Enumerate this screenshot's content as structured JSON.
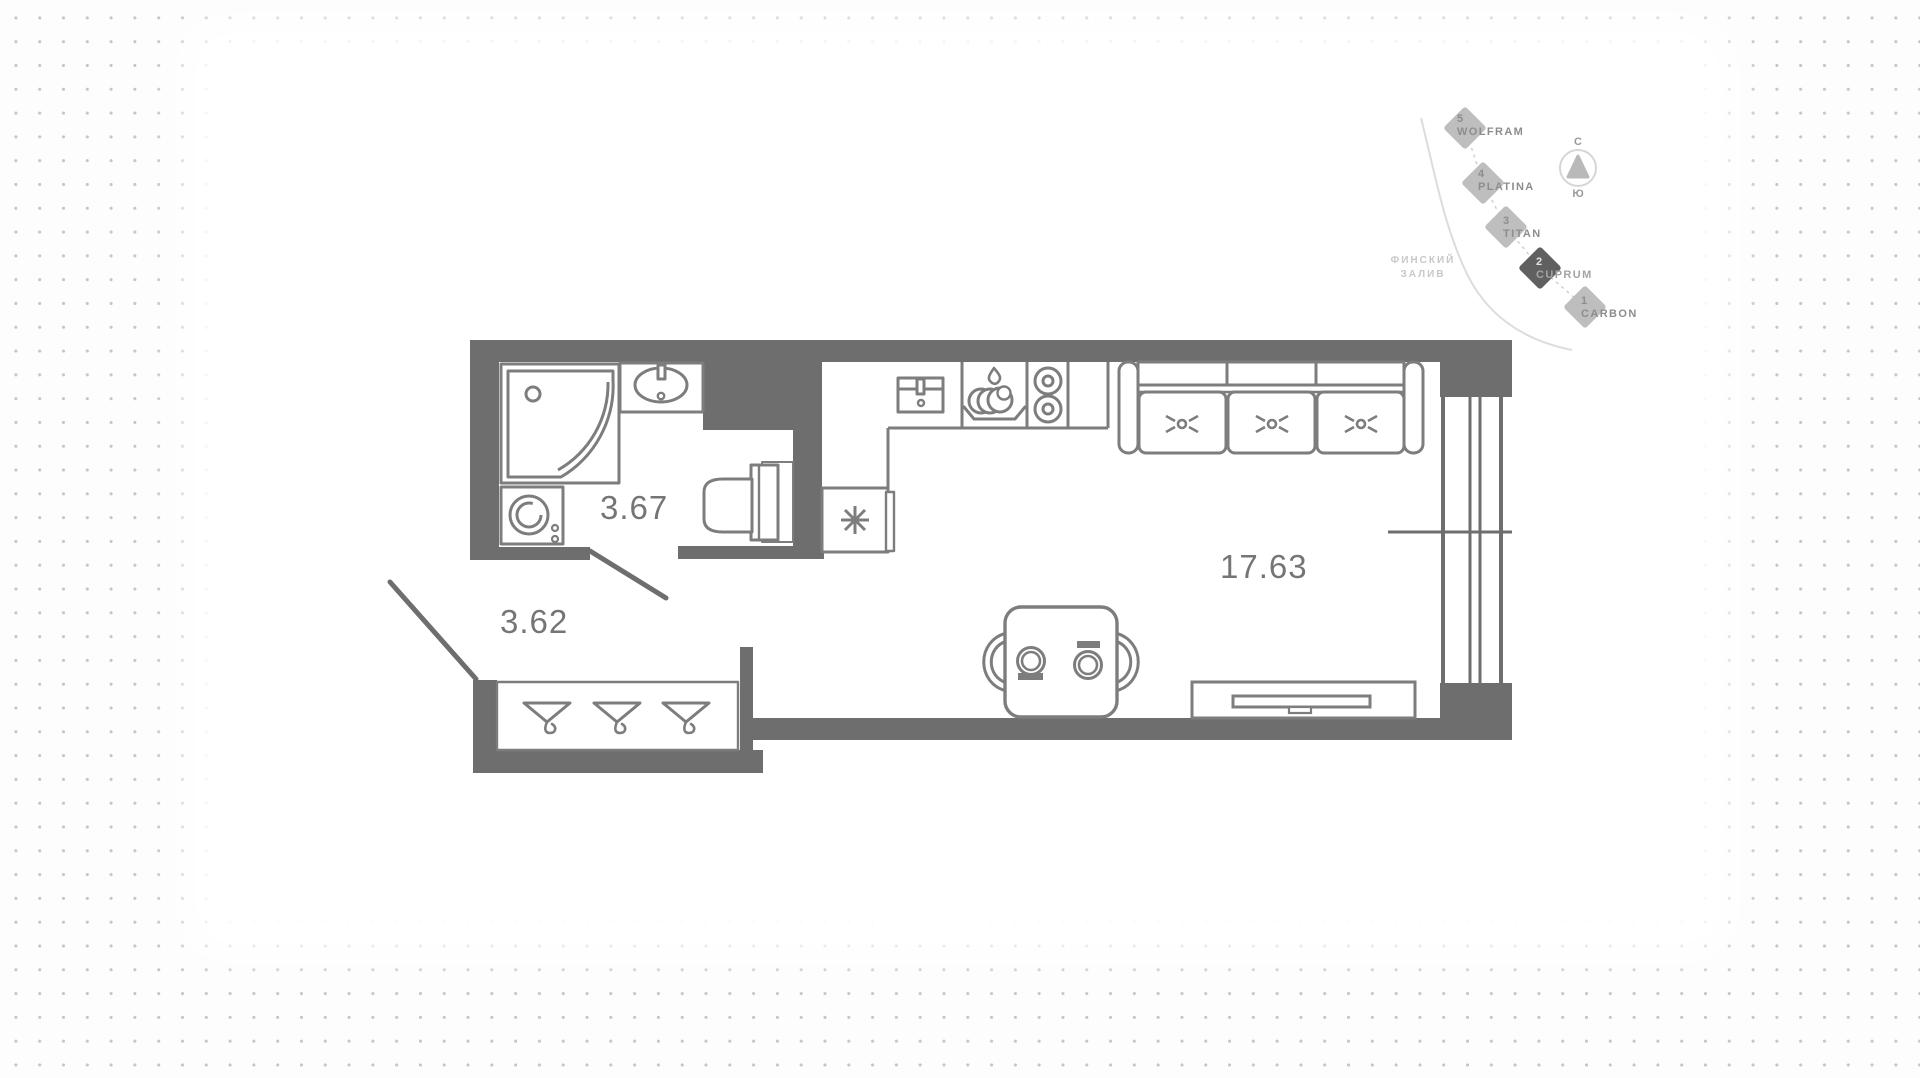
{
  "floorplan": {
    "rooms": [
      {
        "id": "bathroom",
        "area": "3.67"
      },
      {
        "id": "hallway",
        "area": "3.62"
      },
      {
        "id": "living-room",
        "area": "17.63"
      }
    ]
  },
  "minimap": {
    "buildings": [
      {
        "number": "5",
        "name": "WOLFRAM",
        "state": "default"
      },
      {
        "number": "4",
        "name": "PLATINA",
        "state": "default"
      },
      {
        "number": "3",
        "name": "TITAN",
        "state": "default"
      },
      {
        "number": "2",
        "name": "CUPRUM",
        "state": "selected"
      },
      {
        "number": "1",
        "name": "CARBON",
        "state": "default"
      }
    ],
    "water_label": {
      "line1": "ФИНСКИЙ",
      "line2": "ЗАЛИВ"
    },
    "compass": {
      "north": "С",
      "south": "Ю"
    }
  },
  "colors": {
    "wall": "#6e6e6e",
    "fixture_outline": "#7d7d7d",
    "room_label": "#757575",
    "diamond": "#bebebe",
    "diamond_selected": "#606060",
    "coastline": "#dcdcdc",
    "background_dot": "#c6c6c6"
  }
}
